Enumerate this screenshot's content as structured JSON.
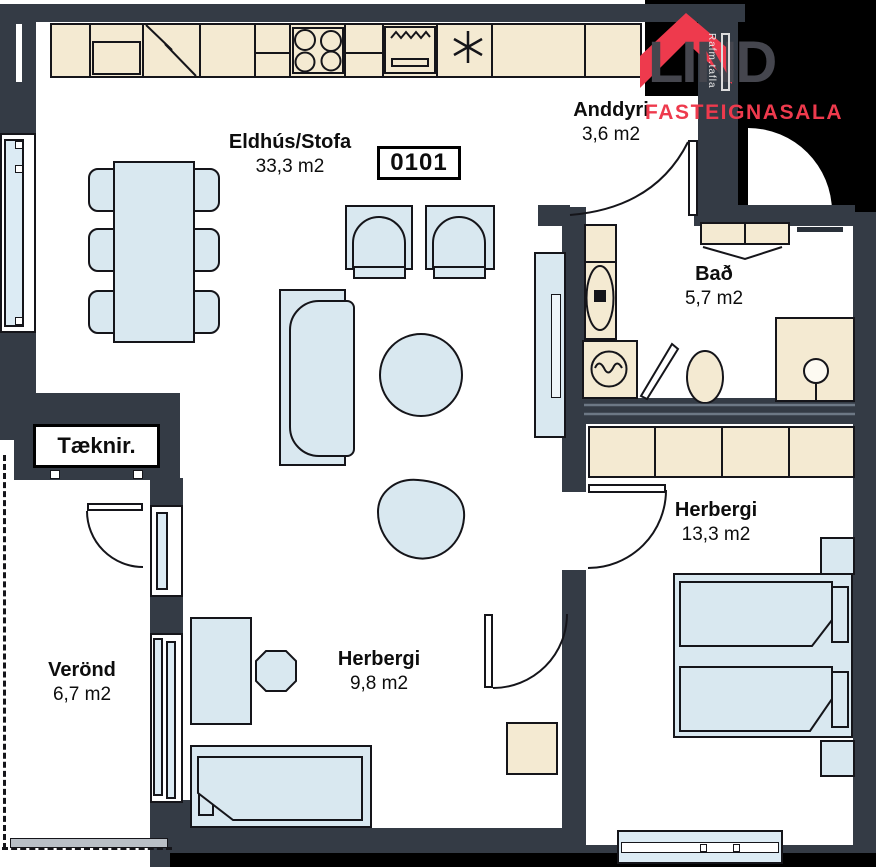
{
  "unit": {
    "number": "0101"
  },
  "logo": {
    "brand": "LIND",
    "subtitle": "FASTEIGNASALA"
  },
  "wall_texts": {
    "electrical_panel": "Rafm.tafla"
  },
  "rooms": {
    "kitchen_living": {
      "name": "Eldhús/Stofa",
      "area": "33,3 m2"
    },
    "entrance": {
      "name": "Anddyri",
      "area": "3,6 m2"
    },
    "bathroom": {
      "name": "Bað",
      "area": "5,7 m2"
    },
    "bedroom_large": {
      "name": "Herbergi",
      "area": "13,3 m2"
    },
    "bedroom_small": {
      "name": "Herbergi",
      "area": "9,8 m2"
    },
    "veranda": {
      "name": "Verönd",
      "area": "6,7 m2"
    },
    "technical": {
      "name": "Tæknir."
    }
  },
  "colors": {
    "wall": "#343b45",
    "outside": "#000000",
    "cabinetry": "#f4ead2",
    "furniture": "#d9e8f0",
    "glazing": "#dcebf4",
    "brand_red": "#ee3a4d",
    "brand_gray": "#45464e"
  }
}
